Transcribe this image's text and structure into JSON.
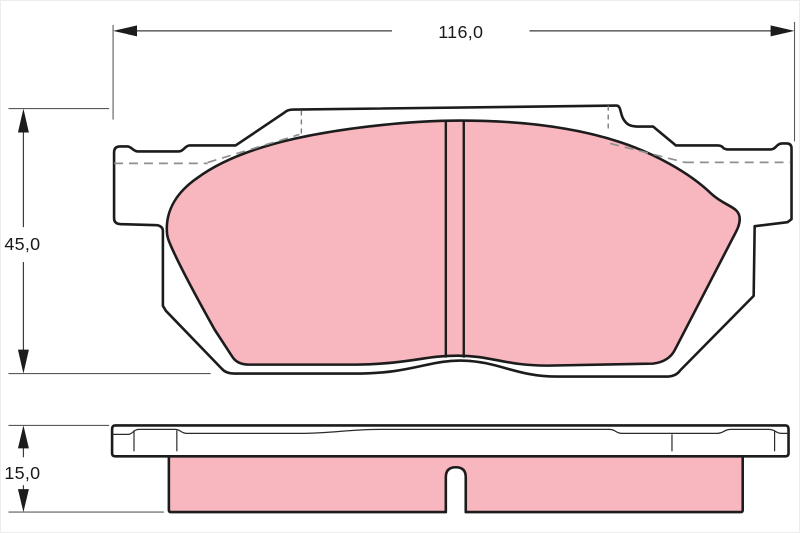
{
  "colors": {
    "friction_material": "#f8b6be",
    "outline": "#1c1c1c",
    "dimension_line": "#3c3c3c",
    "hidden_line": "#8f8f8f",
    "background": "#ffffff"
  },
  "dimensions": {
    "width": {
      "label": "116,0"
    },
    "height": {
      "label": "45,0"
    },
    "thickness": {
      "label": "15,0"
    }
  }
}
